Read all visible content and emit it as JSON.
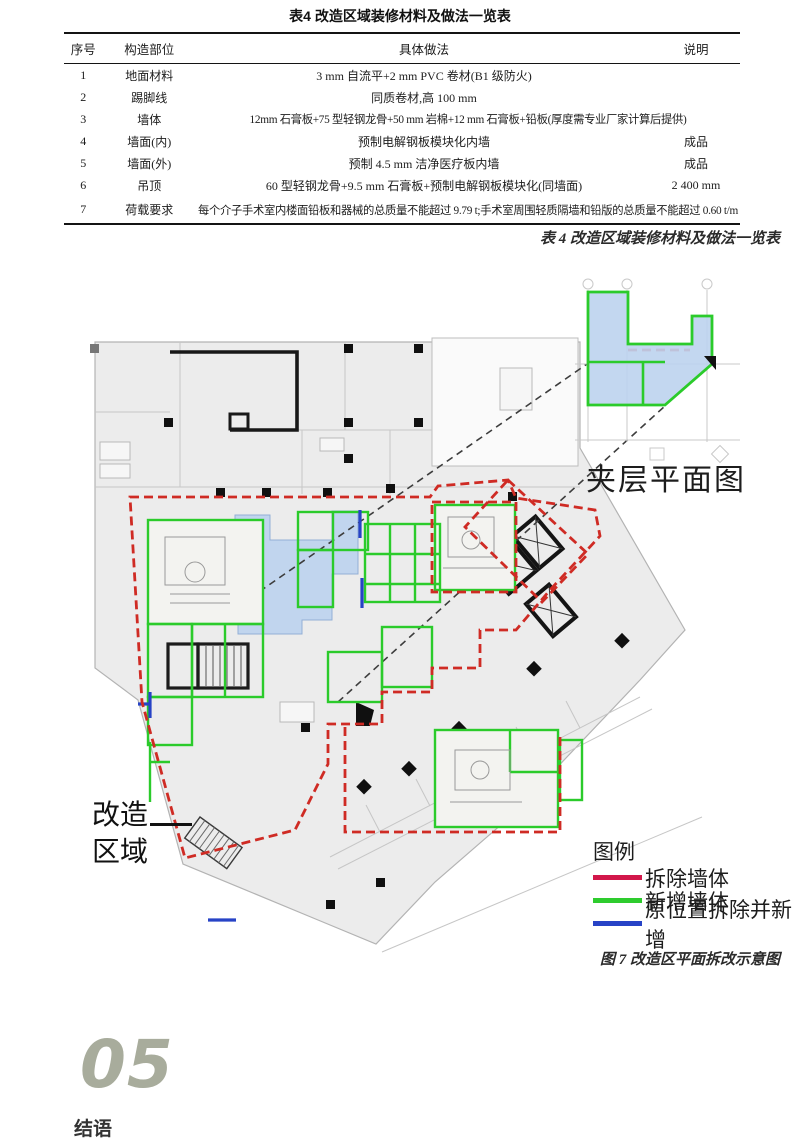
{
  "table": {
    "title": "表4 改造区域装修材料及做法一览表",
    "headers": {
      "no": "序号",
      "part": "构造部位",
      "method": "具体做法",
      "note": "说明"
    },
    "rows": [
      {
        "no": "1",
        "part": "地面材料",
        "method": "3 mm 自流平+2 mm PVC 卷材(B1 级防火)",
        "note": ""
      },
      {
        "no": "2",
        "part": "踢脚线",
        "method": "同质卷材,高 100 mm",
        "note": ""
      },
      {
        "no": "3",
        "part": "墙体",
        "method": "12mm 石膏板+75 型轻钢龙骨+50 mm 岩棉+12 mm 石膏板+铅板(厚度需专业厂家计算后提供)",
        "note": ""
      },
      {
        "no": "4",
        "part": "墙面(内)",
        "method": "预制电解钢板模块化内墙",
        "note": "成品"
      },
      {
        "no": "5",
        "part": "墙面(外)",
        "method": "预制 4.5 mm 洁净医疗板内墙",
        "note": "成品"
      },
      {
        "no": "6",
        "part": "吊顶",
        "method": "60 型轻钢龙骨+9.5 mm 石膏板+预制电解钢板模块化(同墙面)",
        "note": "2 400 mm"
      },
      {
        "no": "7",
        "part": "荷载要求",
        "method": "每个介子手术室内楼面铅板和器械的总质量不能超过 9.79 t;手术室周围轻质隔墙和铅版的总质量不能超过 0.60 t/m",
        "note": ""
      }
    ],
    "caption": "表 4 改造区域装修材料及做法一览表"
  },
  "figure": {
    "mezzanine_label": "夹层平面图",
    "area_label_line1": "改造",
    "area_label_line2": "区域",
    "legend_title": "图例",
    "legend_items": [
      {
        "label": "拆除墙体",
        "color": "#d2174a"
      },
      {
        "label": "新增墙体",
        "color": "#2ecc2e"
      },
      {
        "label": "原位置拆除并新增",
        "color": "#2743c6"
      }
    ],
    "caption": "图 7 改造区平面拆改示意图",
    "colors": {
      "demolish_boundary": "#cf2b24",
      "new_wall": "#2bcb2b",
      "reposition": "#2743c6",
      "highlight_fill": "#bdd3ee"
    }
  },
  "section": {
    "number": "05",
    "title": "结语",
    "number_color": "#a8ac9c"
  }
}
